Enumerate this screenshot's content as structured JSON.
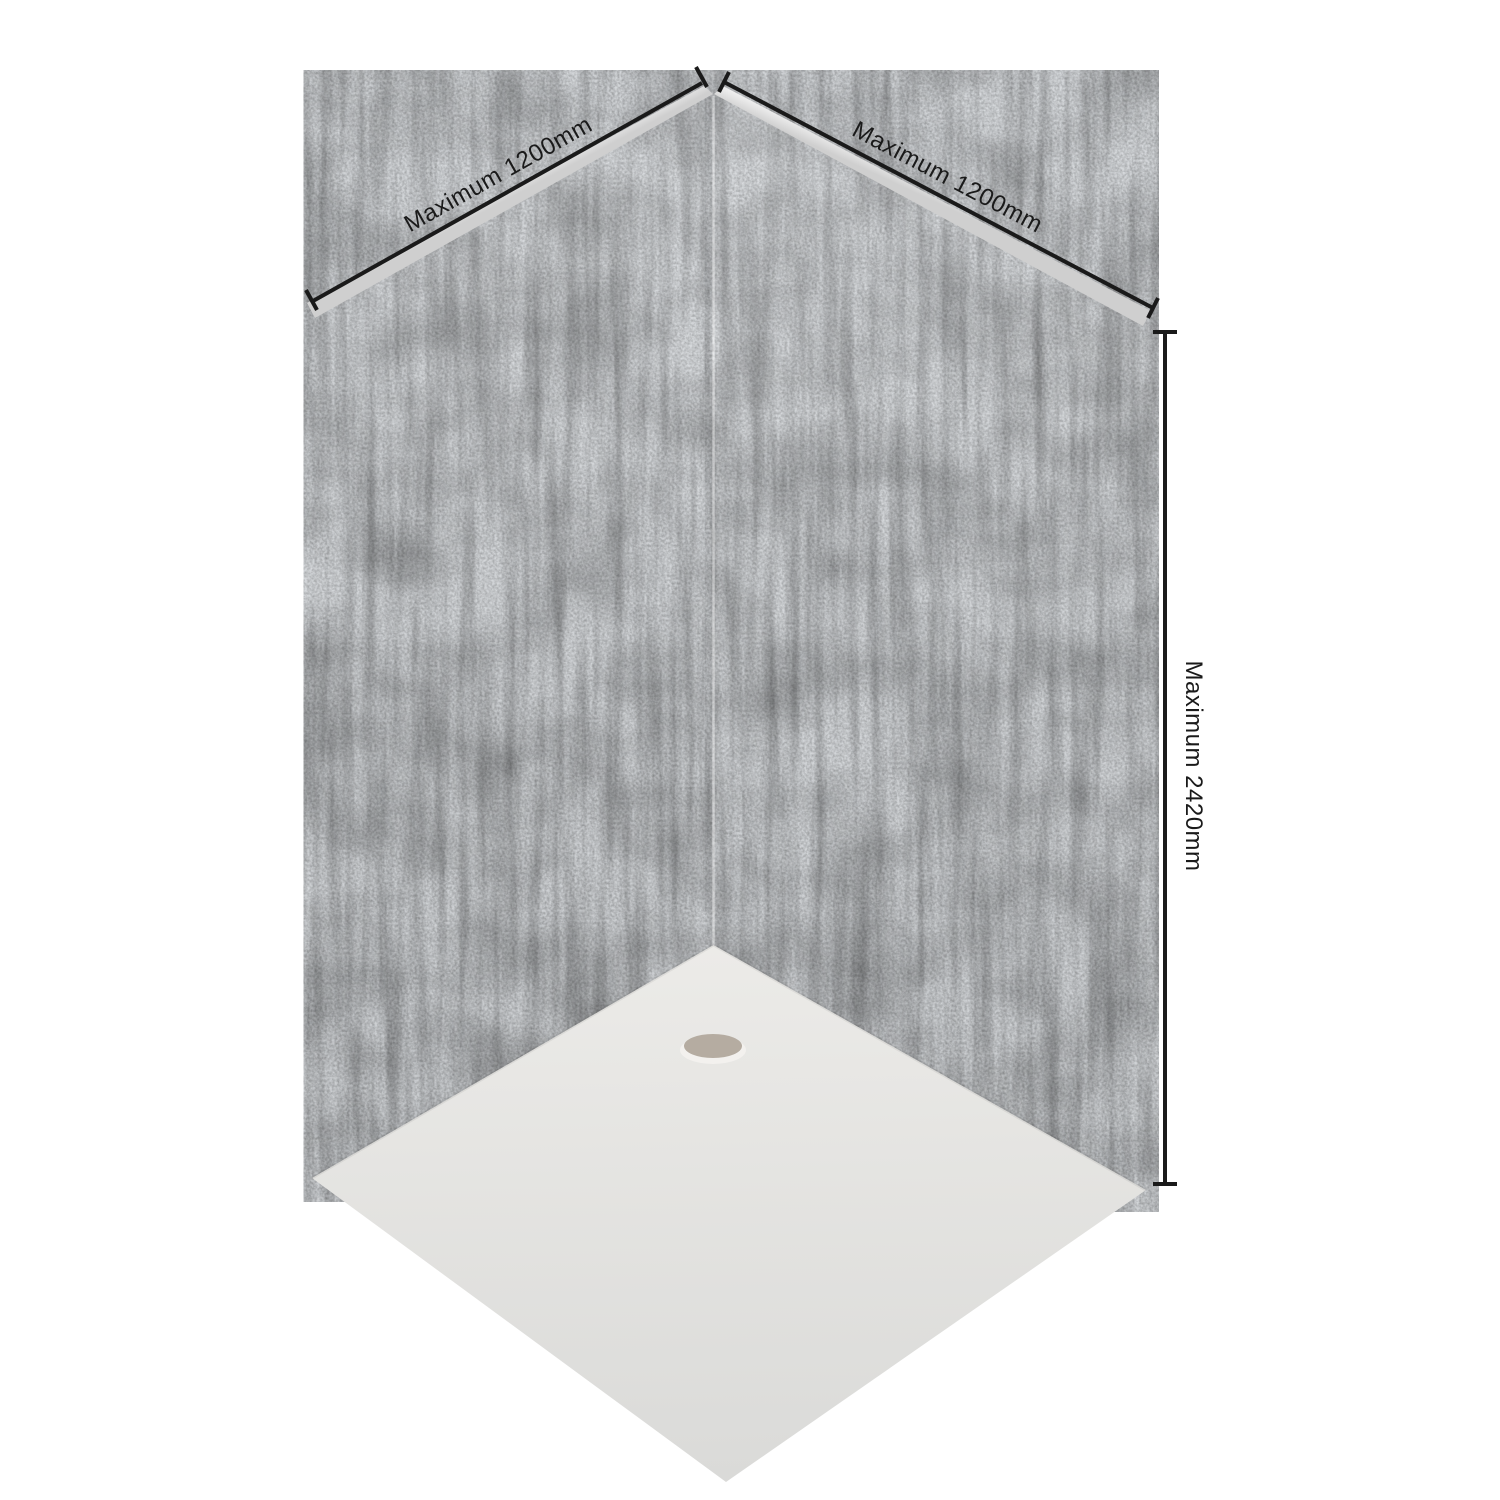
{
  "diagram": {
    "labels": {
      "left_width": "Maximum 1200mm",
      "right_width": "Maximum 1200mm",
      "height": "Maximum 2420mm"
    },
    "colors": {
      "background": "#ffffff",
      "dimension_line": "#1a1a1a",
      "label_text": "#1a1a1a",
      "wall_concrete": "#a4a8ad",
      "wall_texture_base": "#d6d9dc",
      "panel_edge_light": "#f4f4f4",
      "panel_edge_dark": "#cfcfcf",
      "tray_light": "#ecebe8",
      "tray_dark": "#dadad8",
      "drain": "#b5aca1",
      "drain_rim": "#f3f1ee"
    }
  }
}
